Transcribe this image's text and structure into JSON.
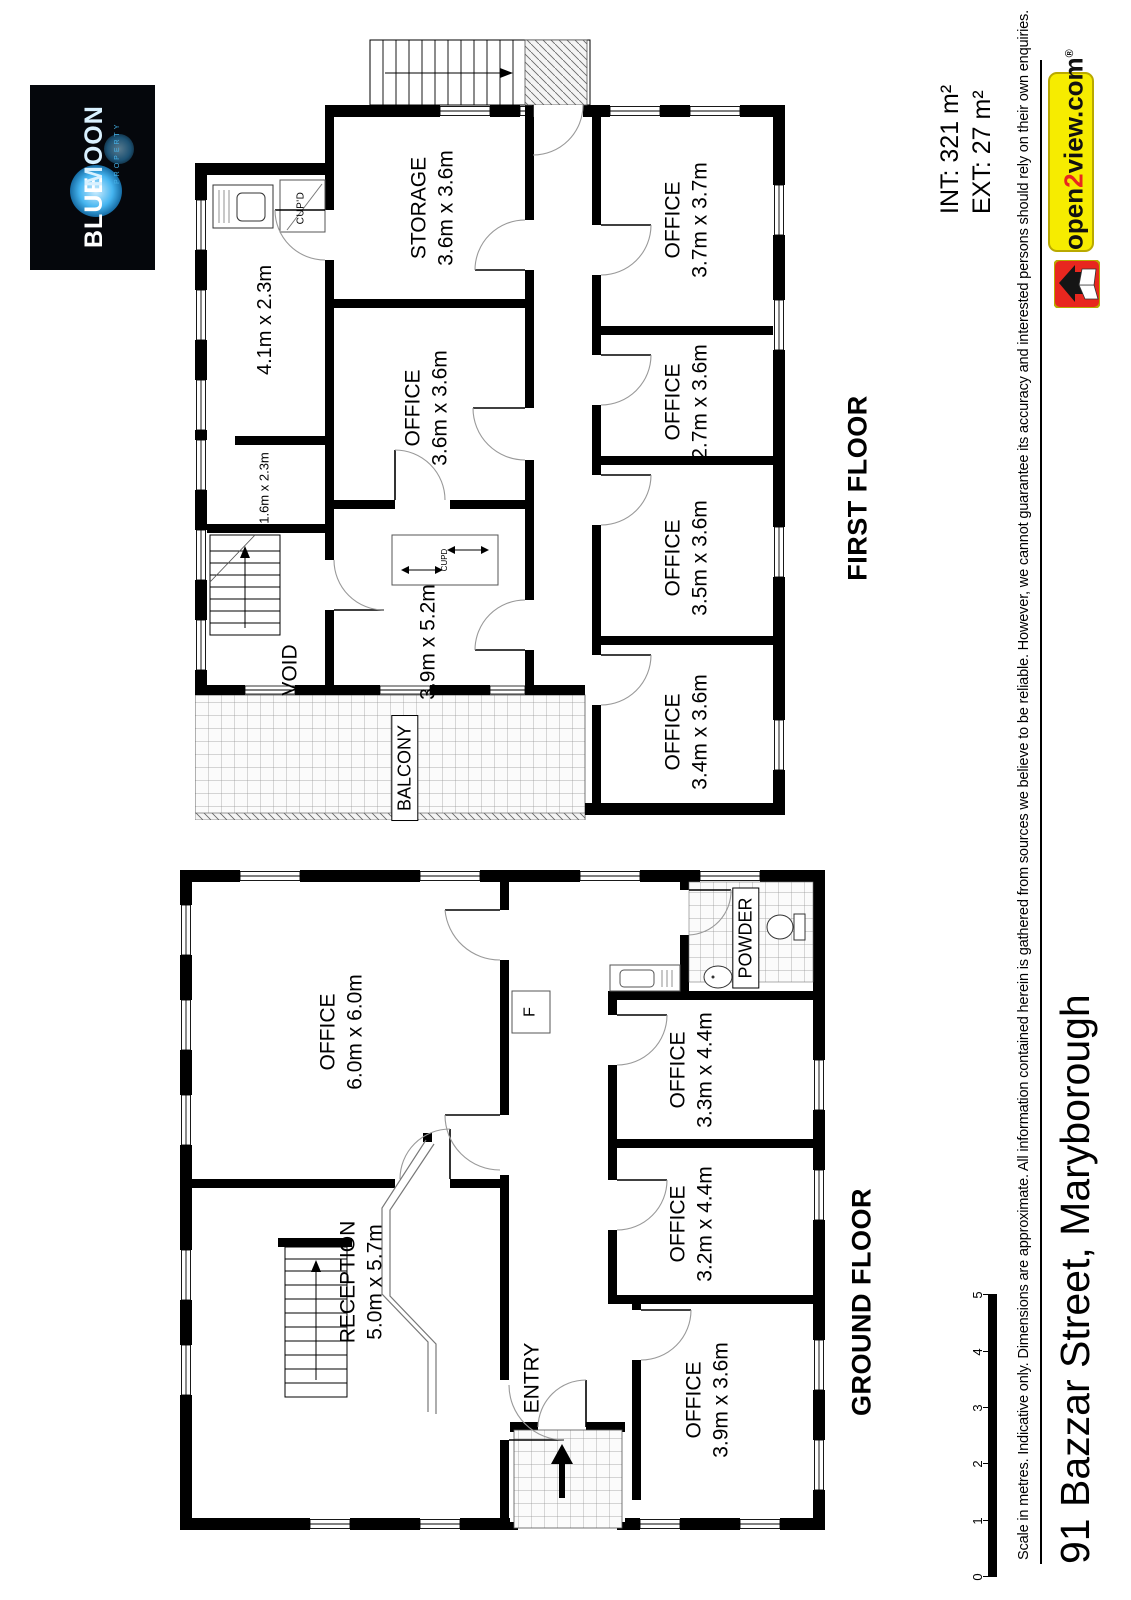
{
  "branding": {
    "blue_moon": {
      "word1": "BLUE",
      "word2": "MOON",
      "tagline": "PROPERTY"
    },
    "open2view": {
      "pre": "open",
      "two": "2",
      "post": "view.com",
      "registered": "®"
    },
    "areas": {
      "int_label": "INT: 321 m²",
      "ext_label": "EXT: 27 m²"
    }
  },
  "floors": {
    "first": {
      "label": "FIRST FLOOR",
      "rooms": [
        {
          "name": "STORAGE",
          "dims": "3.6m x 3.6m"
        },
        {
          "name": "OFFICE",
          "dims": "3.7m x 3.7m"
        },
        {
          "name": "OFFICE",
          "dims": "2.7m x 3.6m"
        },
        {
          "name": "OFFICE",
          "dims": "3.5m x 3.6m"
        },
        {
          "name": "OFFICE",
          "dims": "3.4m x 3.6m"
        },
        {
          "name": "OFFICE",
          "dims": "3.6m x 3.6m"
        },
        {
          "name": "",
          "dims": "4.1m x 2.3m"
        },
        {
          "name": "",
          "dims": "1.6m x 2.3m"
        },
        {
          "name": "",
          "dims": "3.9m x 5.2m"
        },
        {
          "name": "VOID",
          "dims": ""
        },
        {
          "name": "BALCONY",
          "dims": ""
        },
        {
          "name": "CUP'D",
          "dims": ""
        },
        {
          "name": "CUPD",
          "dims": ""
        }
      ]
    },
    "ground": {
      "label": "GROUND FLOOR",
      "rooms": [
        {
          "name": "OFFICE",
          "dims": "6.0m x 6.0m"
        },
        {
          "name": "RECEPTION",
          "dims": "5.0m x 5.7m"
        },
        {
          "name": "OFFICE",
          "dims": "3.3m x 4.4m"
        },
        {
          "name": "OFFICE",
          "dims": "3.2m x 4.4m"
        },
        {
          "name": "OFFICE",
          "dims": "3.9m x 3.6m"
        },
        {
          "name": "POWDER",
          "dims": ""
        },
        {
          "name": "ENTRY",
          "dims": ""
        },
        {
          "name": "F",
          "dims": ""
        }
      ]
    }
  },
  "footer": {
    "disclaimer": "Scale in metres. Indicative only. Dimensions are approximate. All information contained herein is gathered from sources we believe to be reliable. However, we cannot guarantee its accuracy and interested persons should rely on their own enquiries.",
    "address": "91 Bazzar Street, Maryborough",
    "scale_ticks": [
      "0",
      "1",
      "2",
      "3",
      "4",
      "5"
    ]
  },
  "colors": {
    "wall": "#000000",
    "banner_yellow": "#f6ec00",
    "logo_red": "#e8271f",
    "moon_blue": "#46b5f0"
  }
}
